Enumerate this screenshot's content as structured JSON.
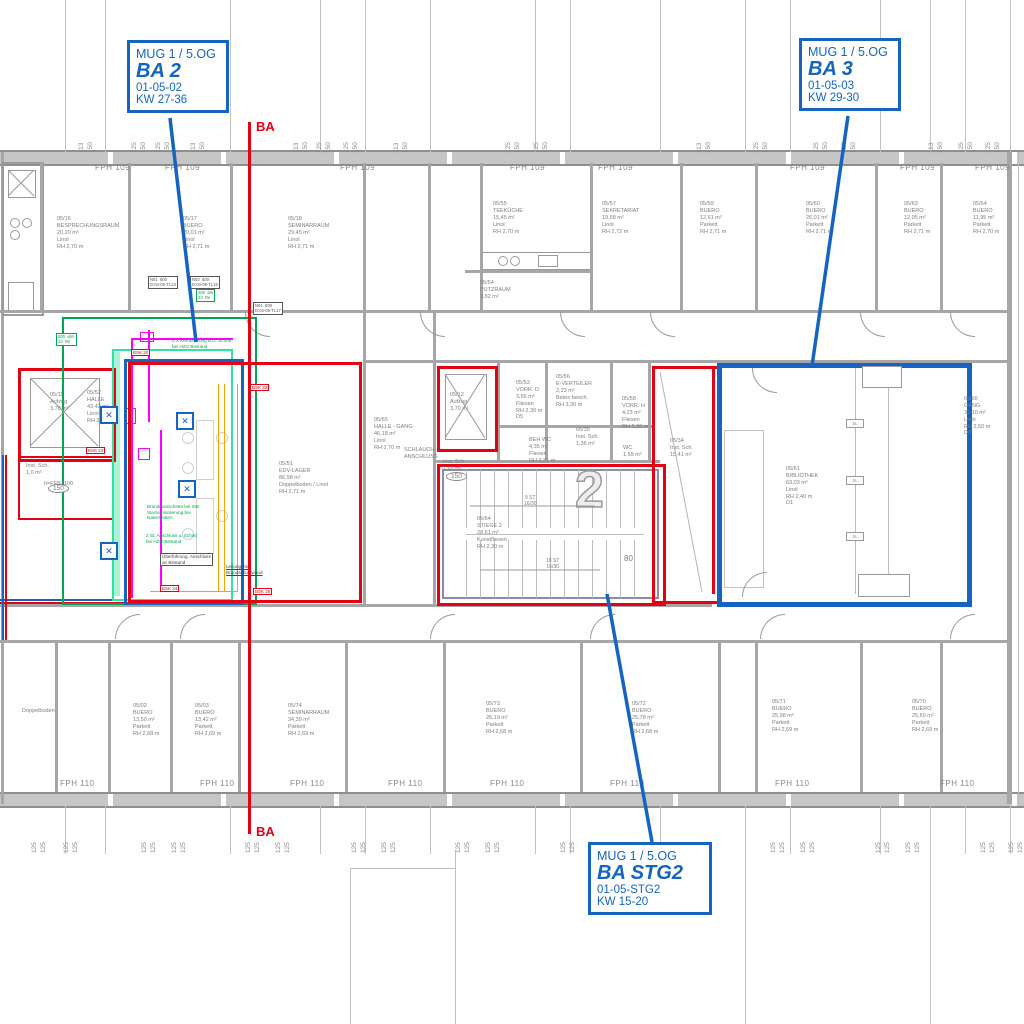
{
  "title_block": {
    "drawing_type": "Grundriss 5.OG Bauabschnitte"
  },
  "colors": {
    "accent_blue": "#1565c0",
    "marker_red": "#e60013",
    "zone_green": "#00a651",
    "zone_springgreen": "#2fe3a2",
    "duct_magenta": "#ff00ff",
    "duct_orange": "#f7a600",
    "wall_gray": "#a6a6a6"
  },
  "callouts": {
    "ba2": {
      "project": "MUG 1 / 5.OG",
      "name": "BA 2",
      "code": "01-05-02",
      "kw": "KW 27-36"
    },
    "ba3": {
      "project": "MUG 1 / 5.OG",
      "name": "BA 3",
      "code": "01-05-03",
      "kw": "KW 29-30"
    },
    "stg2": {
      "project": "MUG 1 / 5.OG",
      "name": "BA STG2",
      "code": "01-05-STG2",
      "kw": "KW 15-20"
    }
  },
  "section_marker": "BA",
  "facade": {
    "top_label": "FPH 109",
    "bottom_label": "FPH 110",
    "top_positions": [
      95,
      165,
      340,
      510,
      598,
      790,
      900,
      975
    ],
    "bottom_positions": [
      60,
      200,
      290,
      388,
      490,
      610,
      775,
      940
    ]
  },
  "dims": {
    "top": [
      {
        "x": 85,
        "v": [
          "113",
          "150"
        ]
      },
      {
        "x": 138,
        "v": [
          "125",
          "150"
        ]
      },
      {
        "x": 162,
        "v": [
          "125",
          "150"
        ]
      },
      {
        "x": 197,
        "v": [
          "113",
          "150"
        ]
      },
      {
        "x": 300,
        "v": [
          "113",
          "150"
        ]
      },
      {
        "x": 323,
        "v": [
          "125",
          "150"
        ]
      },
      {
        "x": 350,
        "v": [
          "125",
          "150"
        ]
      },
      {
        "x": 400,
        "v": [
          "113",
          "150"
        ]
      },
      {
        "x": 512,
        "v": [
          "125",
          "150"
        ]
      },
      {
        "x": 540,
        "v": [
          "125",
          "150"
        ]
      },
      {
        "x": 703,
        "v": [
          "113",
          "150"
        ]
      },
      {
        "x": 760,
        "v": [
          "125",
          "150"
        ]
      },
      {
        "x": 820,
        "v": [
          "125",
          "150"
        ]
      },
      {
        "x": 848,
        "v": [
          "125",
          "150"
        ]
      },
      {
        "x": 935,
        "v": [
          "113",
          "150"
        ]
      },
      {
        "x": 965,
        "v": [
          "125",
          "150"
        ]
      },
      {
        "x": 992,
        "v": [
          "125",
          "150"
        ]
      }
    ],
    "bottom": [
      {
        "x": 38,
        "v": [
          "125",
          "125"
        ]
      },
      {
        "x": 70,
        "v": [
          "125",
          "125"
        ]
      },
      {
        "x": 148,
        "v": [
          "125",
          "125"
        ]
      },
      {
        "x": 178,
        "v": [
          "125",
          "125"
        ]
      },
      {
        "x": 252,
        "v": [
          "125",
          "125"
        ]
      },
      {
        "x": 282,
        "v": [
          "125",
          "125"
        ]
      },
      {
        "x": 358,
        "v": [
          "125",
          "125"
        ]
      },
      {
        "x": 388,
        "v": [
          "125",
          "125"
        ]
      },
      {
        "x": 462,
        "v": [
          "125",
          "125"
        ]
      },
      {
        "x": 492,
        "v": [
          "125",
          "125"
        ]
      },
      {
        "x": 567,
        "v": [
          "125",
          "125"
        ]
      },
      {
        "x": 597,
        "v": [
          "125",
          "125"
        ]
      },
      {
        "x": 672,
        "v": [
          "125",
          "125"
        ]
      },
      {
        "x": 702,
        "v": [
          "125",
          "125"
        ]
      },
      {
        "x": 777,
        "v": [
          "125",
          "125"
        ]
      },
      {
        "x": 807,
        "v": [
          "125",
          "125"
        ]
      },
      {
        "x": 882,
        "v": [
          "125",
          "125"
        ]
      },
      {
        "x": 912,
        "v": [
          "125",
          "125"
        ]
      },
      {
        "x": 987,
        "v": [
          "125",
          "125"
        ]
      },
      {
        "x": 1015,
        "v": [
          "125",
          "125"
        ]
      }
    ]
  },
  "rooms": [
    {
      "id": "05/16",
      "name": "BESPRECHUNGSRAUM",
      "area": "20,20 m²",
      "floor": "Linol",
      "rh": "RH 2,70 m",
      "x": 57,
      "y": 216
    },
    {
      "id": "05/17",
      "name": "BUERO",
      "area": "20,01 m²",
      "floor": "Linol",
      "rh": "RH 2,71 m",
      "x": 183,
      "y": 216
    },
    {
      "id": "05/18",
      "name": "SEMINARRAUM",
      "area": "29,45 m²",
      "floor": "Linol",
      "rh": "RH 2,71 m",
      "x": 288,
      "y": 216
    },
    {
      "id": "05/55",
      "name": "TEEKÜCHE",
      "area": "15,45 m²",
      "floor": "Linol",
      "rh": "RH 2,70 m",
      "x": 493,
      "y": 201
    },
    {
      "id": "05/57",
      "name": "SEKRETARIAT",
      "area": "19,58 m²",
      "floor": "Linol",
      "rh": "RH 2,72 m",
      "x": 602,
      "y": 201
    },
    {
      "id": "05/59",
      "name": "BUERO",
      "area": "12,61 m²",
      "floor": "Parkett",
      "rh": "RH 2,71 m",
      "x": 700,
      "y": 201
    },
    {
      "id": "05/60",
      "name": "BUERO",
      "area": "26,01 m²",
      "floor": "Parkett",
      "rh": "RH 2,71 m",
      "x": 806,
      "y": 201
    },
    {
      "id": "05/63",
      "name": "BUERO",
      "area": "12,05 m²",
      "floor": "Parkett",
      "rh": "RH 2,71 m",
      "x": 904,
      "y": 201
    },
    {
      "id": "05/64",
      "name": "BUERO",
      "area": "11,95 m²",
      "floor": "Parkett",
      "rh": "RH 2,70 m",
      "x": 973,
      "y": 201
    },
    {
      "id": "05/54",
      "name": "PUTZRAUM",
      "area": "3,82 m²",
      "x": 480,
      "y": 280
    },
    {
      "id": "05/11",
      "name": "Aufzug",
      "area": "3,78 m²",
      "x": 50,
      "y": 392
    },
    {
      "id": "05/52",
      "name": "HALLE",
      "area": "43,42 m²",
      "floor": "Linol",
      "rh": "RH 2,60 m",
      "x": 87,
      "y": 390
    },
    {
      "id": "05/65",
      "name": "HALLE - GANG",
      "area": "46,18 m²",
      "floor": "Linol",
      "rh": "RH 2,70 m",
      "x": 374,
      "y": 417
    },
    {
      "id": "05/12",
      "name": "Aufzug",
      "area": "3,70 m²",
      "x": 450,
      "y": 392
    },
    {
      "name": "Inst. Sch.",
      "area": "1,0 m²",
      "x": 26,
      "y": 463
    },
    {
      "name": "Inst. Sch.",
      "area": "1,65 m²",
      "x": 443,
      "y": 459
    },
    {
      "id": "05/53",
      "name": "VORR. D",
      "area": "3,56 m²",
      "floor": "Fliesen",
      "rh": "RH 2,30 m",
      "extra": "D5",
      "x": 516,
      "y": 380
    },
    {
      "id": "05/56",
      "name": "E-VERTEILER",
      "area": "2,23 m²",
      "floor": "Beton besch.",
      "rh": "RH 3,30 m",
      "x": 556,
      "y": 374
    },
    {
      "id": "05/58",
      "name": "VORR. H",
      "area": "4,23 m²",
      "floor": "Fliesen",
      "rh": "RH 2,30 m",
      "x": 622,
      "y": 396
    },
    {
      "name": "BEH WC",
      "area": "4,35 m²",
      "floor": "Fliesen",
      "rh": "RH 2,31 m",
      "x": 529,
      "y": 437
    },
    {
      "id": "05/35",
      "name": "Inst. Sch.",
      "area": "1,36 m²",
      "x": 576,
      "y": 427
    },
    {
      "name": "WC",
      "area": "1,59 m²",
      "x": 623,
      "y": 445
    },
    {
      "id": "05/51",
      "name": "EDV-LAGER",
      "area": "86,98 m²",
      "floor": "Doppelboden / Linol",
      "rh": "RH 2,71 m",
      "x": 279,
      "y": 461
    },
    {
      "id": "05/64",
      "name": "STIEGE 2",
      "area": "28,61 m²",
      "floor": "Kunstfliesen",
      "rh": "RH 2,30 m",
      "x": 477,
      "y": 516
    },
    {
      "id": "05/34",
      "name": "Inst. Sch.",
      "area": "15,41 m²",
      "x": 670,
      "y": 438
    },
    {
      "id": "05/61",
      "name": "BIBLIOTHEK",
      "area": "63,03 m²",
      "floor": "Linol",
      "rh": "RH 2,40 m",
      "extra": "D1",
      "x": 786,
      "y": 466
    },
    {
      "id": "05/66",
      "name": "GANG",
      "area": "39,10 m²",
      "floor": "Linol",
      "rh": "RH 2,50 m",
      "extra": "D3",
      "x": 964,
      "y": 396
    },
    {
      "name": "Doppelboden",
      "x": 22,
      "y": 708
    },
    {
      "id": "05/02",
      "name": "BUERO",
      "area": "13,50 m²",
      "floor": "Parkett",
      "rh": "RH 2,68 m",
      "x": 133,
      "y": 703
    },
    {
      "id": "05/03",
      "name": "BUERO",
      "area": "13,42 m²",
      "floor": "Parkett",
      "rh": "RH 2,69 m",
      "x": 195,
      "y": 703
    },
    {
      "id": "05/74",
      "name": "SEMINARRAUM",
      "area": "34,39 m²",
      "floor": "Parkett",
      "rh": "RH 2,69 m",
      "x": 288,
      "y": 703
    },
    {
      "id": "05/73",
      "name": "BUERO",
      "area": "26,19 m²",
      "floor": "Parkett",
      "rh": "RH 2,68 m",
      "x": 486,
      "y": 701
    },
    {
      "id": "05/72",
      "name": "BUERO",
      "area": "25,78 m²",
      "floor": "Parkett",
      "rh": "RH 2,68 m",
      "x": 632,
      "y": 701
    },
    {
      "id": "05/71",
      "name": "BUERO",
      "area": "25,98 m²",
      "floor": "Parkett",
      "rh": "RH 2,69 m",
      "x": 772,
      "y": 699
    },
    {
      "id": "05/70",
      "name": "BUERO",
      "area": "25,69 m²",
      "floor": "Parkett",
      "rh": "RH 2,69 m",
      "x": 912,
      "y": 699
    }
  ],
  "stair": {
    "flight1": "9 ST",
    "riser1": "16/30",
    "flight2": "18 ST",
    "riser2": "16/30",
    "numeral": "2",
    "dim": "80"
  },
  "notes_green": [
    {
      "text": "2 X Kernbohrung ø.G. Schott\nbei HZG Bestand",
      "x": 172,
      "y": 338
    },
    {
      "text": "Brandmanschette bei SW\nSteckenisolierung bei\nNassmedien.",
      "x": 147,
      "y": 504
    },
    {
      "text": "2 St. Anschluss u. Schott\nbei HZG Bestand",
      "x": 146,
      "y": 533
    }
  ],
  "notes_black": [
    {
      "text": "Überführung, Anschluss\nan Bestand",
      "x": 160,
      "y": 553,
      "boxed": true
    },
    {
      "text": "Leitung vor\nBrandschutzwand",
      "x": 226,
      "y": 564,
      "boxed": false
    }
  ],
  "bsk_labels": [
    {
      "text": "BSK 20",
      "x": 131,
      "y": 349
    },
    {
      "text": "BSK 22",
      "x": 250,
      "y": 384
    },
    {
      "text": "BSK 23",
      "x": 86,
      "y": 447
    },
    {
      "text": "BSK 24",
      "x": 160,
      "y": 585
    },
    {
      "text": "BSK 26",
      "x": 253,
      "y": 588
    }
  ],
  "mini_tables": [
    {
      "l1": "N01  600",
      "l2": "D:04-05-TL13",
      "x": 148,
      "y": 276,
      "green": false
    },
    {
      "l1": "N02  600",
      "l2": "D:04-05-TL15",
      "x": 190,
      "y": 276,
      "green": false
    },
    {
      "l1": "N01  600",
      "l2": "D:04-05-TL17",
      "x": 253,
      "y": 302,
      "green": false
    },
    {
      "l1": "200  ø/s",
      "l2": "23  Re",
      "x": 196,
      "y": 289,
      "green": true
    },
    {
      "l1": "200  ø/m",
      "l2": "23  Re",
      "x": 56,
      "y": 333,
      "green": true
    }
  ],
  "ovals": {
    "text": "150",
    "positions": [
      {
        "x": 48,
        "y": 484
      },
      {
        "x": 446,
        "y": 472
      }
    ]
  },
  "sl_markers": {
    "text": "SL",
    "positions": [
      {
        "x": 846,
        "y": 419
      },
      {
        "x": 846,
        "y": 476
      },
      {
        "x": 846,
        "y": 532
      }
    ]
  },
  "misc_labels": [
    {
      "text": "SCHLAUCH-\nANSCHLUSS",
      "x": 404,
      "y": 447
    },
    {
      "text": "h=FFB+100",
      "x": 44,
      "y": 481
    }
  ]
}
